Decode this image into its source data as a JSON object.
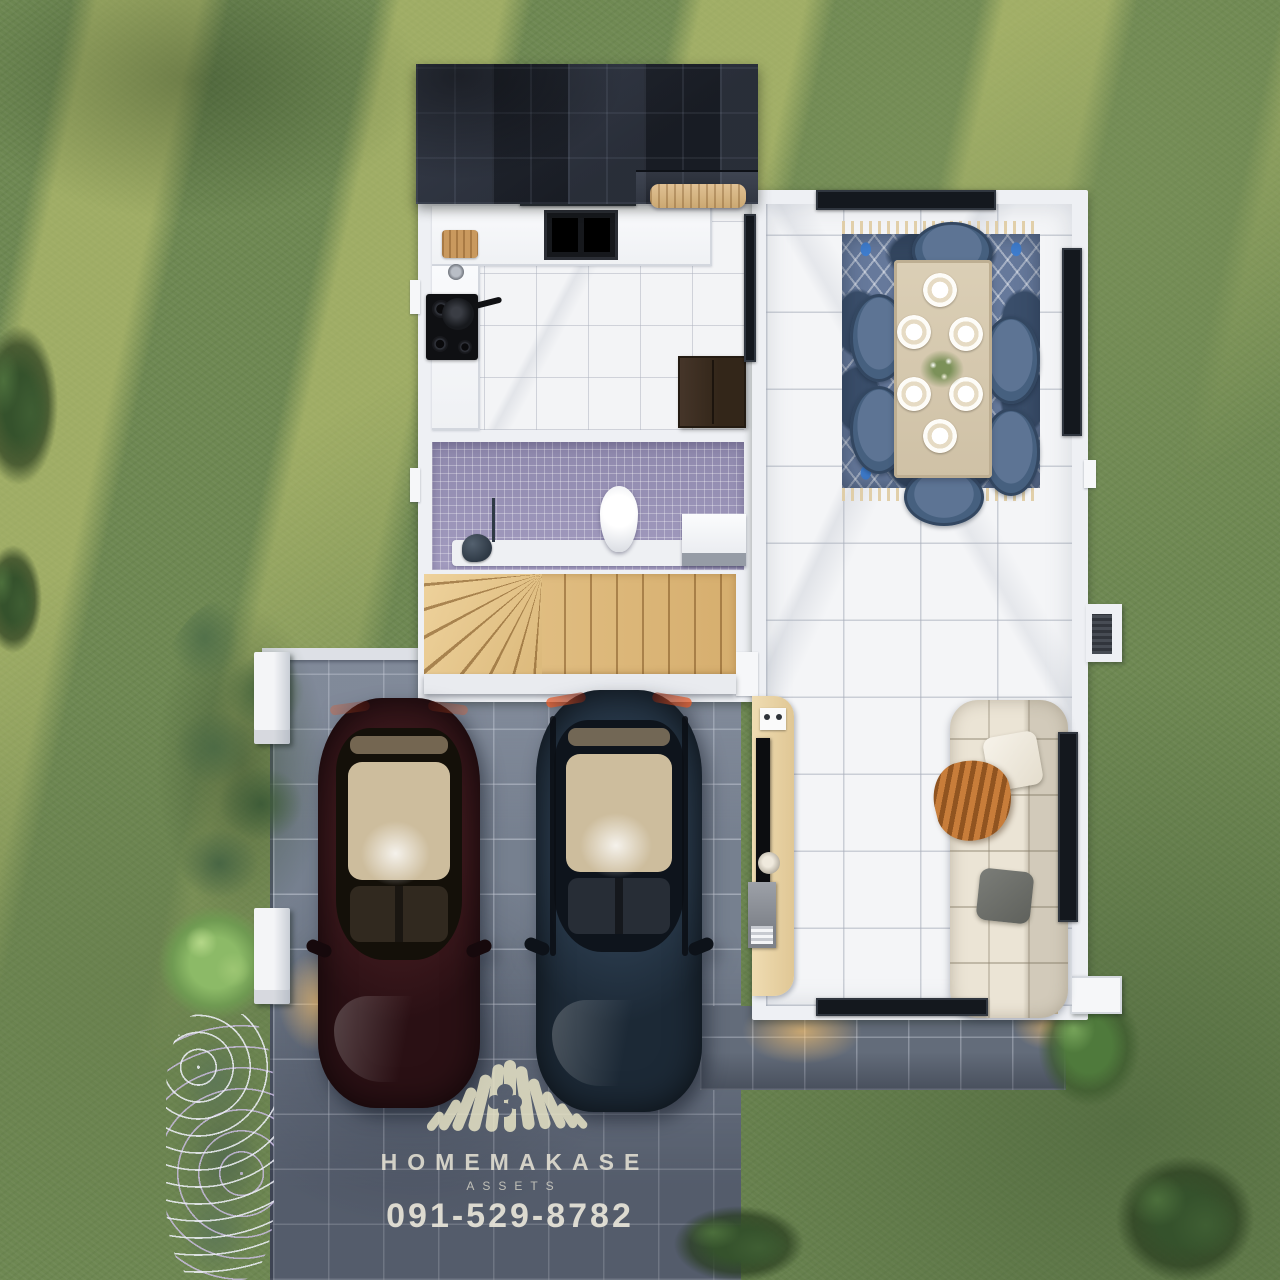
{
  "watermark": {
    "brand": "HOMEMAKASE",
    "division": "ASSETS",
    "phone": "091-529-8782",
    "logo": "thatched-roof-fan-logo"
  },
  "scene": {
    "type": "top-down 3D render of a single-storey house floor plan",
    "environment": {
      "lawn": "green grass with diagonal sunlight streaks (upper left)",
      "driveway": "grey tiled carport with two parked cars",
      "terrace": "grey tiled strip along the south wall",
      "roof": "dark slate tile roof over the kitchen wing"
    },
    "rooms": [
      {
        "name": "kitchen",
        "items": [
          "counter",
          "double-sink",
          "cooktop-with-pan",
          "cutting-board",
          "refrigerator-cabinet"
        ]
      },
      {
        "name": "bathroom",
        "items": [
          "mosaic-floor",
          "toilet",
          "vanity-sink",
          "shower-set"
        ]
      },
      {
        "name": "staircase",
        "items": [
          "wood-treads",
          "winder-steps"
        ]
      },
      {
        "name": "dining-area",
        "items": [
          "six-seat-table",
          "six-blue-chairs",
          "blue-pattern-rug",
          "place-settings",
          "flower-centerpiece"
        ]
      },
      {
        "name": "living-area",
        "items": [
          "cream-sofa",
          "white-pillow",
          "grey-pillow",
          "orange-throw",
          "tv-console",
          "flat-tv",
          "speaker",
          "printer"
        ]
      }
    ],
    "vehicles": [
      {
        "name": "car-burgundy",
        "body_color": "#2e1317"
      },
      {
        "name": "car-navy",
        "body_color": "#22303f"
      }
    ],
    "landscape_items": [
      "corner-trees",
      "shrub-row",
      "round-light-tree",
      "flowering-border",
      "south-east-bush",
      "south-trees"
    ]
  },
  "palette": {
    "grass": "#6e8852",
    "sun_streak": "#c8cc76",
    "driveway": "#76808f",
    "terrace": "#636c7a",
    "roof": "#242936",
    "wall": "#eef0f4",
    "marble": "#f4f5f7",
    "bath_mosaic": "#9e97ba",
    "stair_wood": "#ddb97b",
    "console_wood": "#e6d1a6",
    "rug_blue": "#66799b",
    "chair_blue": "#54698a",
    "sofa_cream": "#ebe4d5",
    "throw_orange": "#b5702f",
    "watermark_text": "#f2edd d"
  }
}
